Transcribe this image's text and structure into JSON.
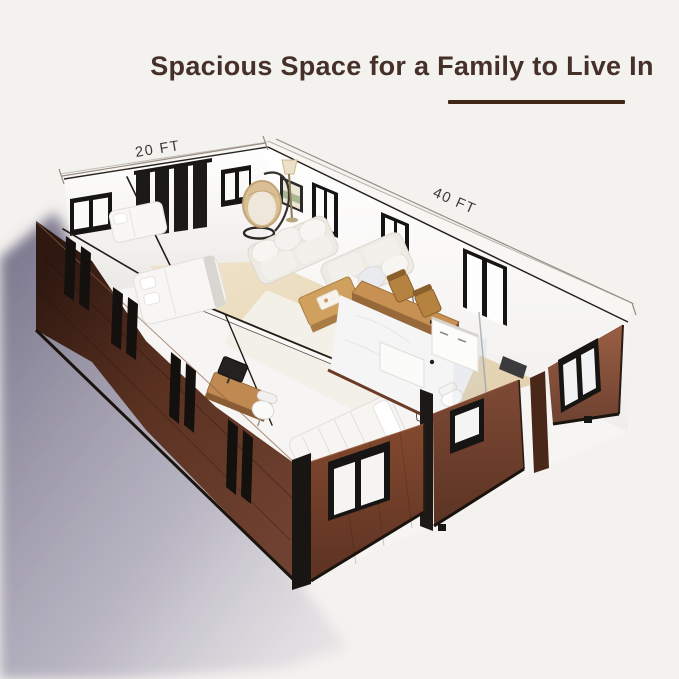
{
  "header": {
    "title": "Spacious Space for a Family to Live In"
  },
  "dimensions": {
    "width_label": "20 FT",
    "length_label": "40 FT"
  },
  "style_tokens": {
    "title_color": "#46302a",
    "underline_color": "#3f2817",
    "siding_brown": "#754330",
    "siding_brown_dark": "#33190f",
    "window_frame_black": "#181512",
    "interior_white": "#fbfaf8",
    "wood_floor_tan": "#ead9ba",
    "ground_shadow_purple": "#67637c",
    "background": "#f4f2ef"
  }
}
